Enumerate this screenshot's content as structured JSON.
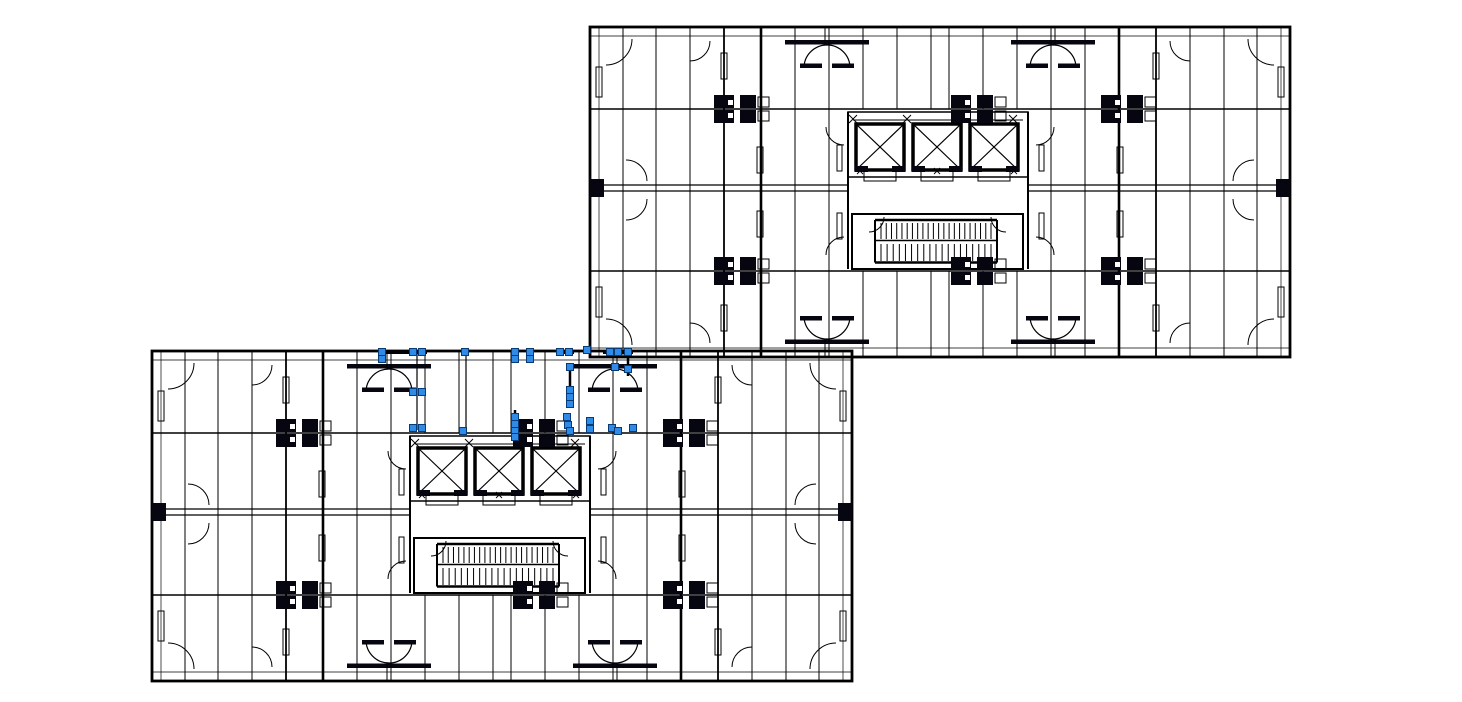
{
  "app": {
    "title": "CAD drawing - twin tower floor plans, lower plan selected"
  },
  "drawing": {
    "canvas": {
      "width": 1462,
      "height": 702,
      "background": "#ffffff"
    },
    "colors": {
      "line": "#000000",
      "fill_block": "#05060f",
      "grip_fill": "#2e8be8",
      "grip_stroke": "#083a75",
      "highlight": "#000000"
    },
    "plans": [
      {
        "name": "floor-plan-upper-right",
        "origin_x": 590,
        "origin_y": 27,
        "selected": false
      },
      {
        "name": "floor-plan-lower-left",
        "origin_x": 152,
        "origin_y": 351,
        "selected": true
      }
    ],
    "template": {
      "w": 700,
      "h": 330,
      "border_w": 2.8,
      "inner_h": [
        {
          "y": 9,
          "w": 0.7
        },
        {
          "y": 321,
          "w": 0.7
        }
      ],
      "inner_v": [
        {
          "x": 9,
          "w": 0.7
        },
        {
          "x": 691,
          "w": 0.7
        }
      ],
      "h_lines": [
        {
          "y": 82,
          "w": 1.4,
          "spans": [
            [
              0,
              700
            ]
          ]
        },
        {
          "y": 158,
          "w": 1.3,
          "spans": [
            [
              0,
              258
            ],
            [
              438,
              700
            ]
          ]
        },
        {
          "y": 164,
          "w": 1.3,
          "spans": [
            [
              0,
              258
            ],
            [
              438,
              700
            ]
          ]
        },
        {
          "y": 244,
          "w": 1.4,
          "spans": [
            [
              0,
              700
            ]
          ]
        }
      ],
      "v_full": [
        {
          "x": 33,
          "w": 1
        },
        {
          "x": 66,
          "w": 1
        },
        {
          "x": 100,
          "w": 1
        },
        {
          "x": 134,
          "w": 1.8
        },
        {
          "x": 171,
          "w": 2.6
        },
        {
          "x": 205,
          "w": 1
        },
        {
          "x": 239,
          "w": 1
        },
        {
          "x": 461,
          "w": 1
        },
        {
          "x": 495,
          "w": 1
        },
        {
          "x": 529,
          "w": 2.6
        },
        {
          "x": 566,
          "w": 1.8
        },
        {
          "x": 600,
          "w": 1
        },
        {
          "x": 634,
          "w": 1
        },
        {
          "x": 667,
          "w": 1
        }
      ],
      "v_center": [
        {
          "x": 273,
          "w": 1
        },
        {
          "x": 307,
          "w": 1
        },
        {
          "x": 341,
          "w": 1
        },
        {
          "x": 359,
          "w": 1
        },
        {
          "x": 393,
          "w": 1
        },
        {
          "x": 427,
          "w": 1
        }
      ],
      "v_center_bands": [
        [
          0,
          82
        ],
        [
          244,
          330
        ]
      ],
      "core_side_walls": [
        {
          "x": 258,
          "y1": 85,
          "y2": 242,
          "w": 2
        },
        {
          "x": 438,
          "y1": 85,
          "y2": 242,
          "w": 2
        }
      ],
      "elevator_bank": {
        "x": 258,
        "y": 85,
        "w": 180,
        "h": 65,
        "inner_top_y": 93,
        "shaft_xs": [
          266,
          323,
          380
        ],
        "shaft_y": 97,
        "shaft_w": 48,
        "shaft_h": 46,
        "shaft_wall": 3.5,
        "x_marks_top": [
          263,
          317,
          368,
          423
        ],
        "x_marks_top_y": 92,
        "x_marks_bot": [
          270,
          347,
          424
        ],
        "x_marks_bot_y": 144,
        "door_y": 144,
        "door_h": 10,
        "threshold_y": 139
      },
      "stair": {
        "x": 262,
        "y": 187,
        "w": 171,
        "h": 55,
        "wall": 2,
        "plate1_y": 193,
        "mid_y": 213.5,
        "plate2_y": 235.5,
        "tread_x1": 291,
        "tread_x2": 401,
        "run1": [
          196,
          212
        ],
        "run2": [
          217,
          234
        ],
        "treads1": 22,
        "treads2": 19,
        "rail_x1": 285,
        "rail_x2": 407
      },
      "blocks": [
        {
          "x": 150,
          "y": 82
        },
        {
          "x": 387,
          "y": 82
        },
        {
          "x": 537,
          "y": 82
        },
        {
          "x": 150,
          "y": 244
        },
        {
          "x": 387,
          "y": 244
        },
        {
          "x": 537,
          "y": 244
        }
      ],
      "edge_ticks": [
        {
          "x": 0,
          "y": 152,
          "w": 14,
          "h": 18
        },
        {
          "x": 686,
          "y": 152,
          "w": 14,
          "h": 18
        }
      ],
      "arcs": [
        {
          "x": 16,
          "y": 12,
          "r": 26,
          "dx": 1,
          "dy": 1,
          "sweep": 1
        },
        {
          "x": 684,
          "y": 12,
          "r": 26,
          "dx": -1,
          "dy": 1,
          "sweep": 0
        },
        {
          "x": 16,
          "y": 318,
          "r": 26,
          "dx": 1,
          "dy": -1,
          "sweep": 0
        },
        {
          "x": 684,
          "y": 318,
          "r": 26,
          "dx": -1,
          "dy": -1,
          "sweep": 1
        },
        {
          "x": 100,
          "y": 14,
          "r": 20,
          "dx": 1,
          "dy": 1,
          "sweep": 1
        },
        {
          "x": 600,
          "y": 14,
          "r": 20,
          "dx": -1,
          "dy": 1,
          "sweep": 0
        },
        {
          "x": 100,
          "y": 316,
          "r": 20,
          "dx": 1,
          "dy": -1,
          "sweep": 0
        },
        {
          "x": 600,
          "y": 316,
          "r": 20,
          "dx": -1,
          "dy": -1,
          "sweep": 1
        },
        {
          "x": 36,
          "y": 154,
          "r": 21,
          "dx": 1,
          "dy": -1,
          "sweep": 0
        },
        {
          "x": 36,
          "y": 172,
          "r": 21,
          "dx": 1,
          "dy": 1,
          "sweep": 1
        },
        {
          "x": 664,
          "y": 154,
          "r": 21,
          "dx": -1,
          "dy": -1,
          "sweep": 1
        },
        {
          "x": 664,
          "y": 172,
          "r": 21,
          "dx": -1,
          "dy": 1,
          "sweep": 0
        },
        {
          "x": 254,
          "y": 100,
          "r": 18,
          "dx": -1,
          "dy": 1,
          "sweep": 0
        },
        {
          "x": 446,
          "y": 100,
          "r": 18,
          "dx": 1,
          "dy": 1,
          "sweep": 1
        },
        {
          "x": 254,
          "y": 228,
          "r": 18,
          "dx": -1,
          "dy": -1,
          "sweep": 1
        },
        {
          "x": 446,
          "y": 228,
          "r": 18,
          "dx": 1,
          "dy": -1,
          "sweep": 0
        },
        {
          "x": 279,
          "y": 190,
          "r": 15,
          "dx": 1,
          "dy": 1,
          "sweep": 1
        },
        {
          "x": 416,
          "y": 190,
          "r": 15,
          "dx": -1,
          "dy": 1,
          "sweep": 0
        }
      ],
      "domes": [
        {
          "cx": 237,
          "base": 41,
          "dir": -1
        },
        {
          "cx": 463,
          "base": 41,
          "dir": -1
        },
        {
          "cx": 237,
          "base": 289,
          "dir": 1
        },
        {
          "cx": 463,
          "base": 289,
          "dir": 1
        }
      ],
      "jambs": [
        [
          6,
          40,
          6,
          30
        ],
        [
          6,
          260,
          6,
          30
        ],
        [
          688,
          40,
          6,
          30
        ],
        [
          688,
          260,
          6,
          30
        ],
        [
          131,
          26,
          6,
          26
        ],
        [
          131,
          278,
          6,
          26
        ],
        [
          563,
          26,
          6,
          26
        ],
        [
          563,
          278,
          6,
          26
        ],
        [
          167,
          120,
          6,
          26
        ],
        [
          167,
          184,
          6,
          26
        ],
        [
          527,
          120,
          6,
          26
        ],
        [
          527,
          184,
          6,
          26
        ],
        [
          247,
          118,
          5,
          26
        ],
        [
          449,
          118,
          5,
          26
        ],
        [
          247,
          186,
          5,
          26
        ],
        [
          449,
          186,
          5,
          26
        ]
      ]
    },
    "selection": {
      "grip_size": 7,
      "grips": [
        [
          382,
          352
        ],
        [
          413,
          352
        ],
        [
          422,
          352
        ],
        [
          465,
          352
        ],
        [
          515,
          352
        ],
        [
          530,
          352
        ],
        [
          560,
          352
        ],
        [
          569,
          352
        ],
        [
          587,
          350
        ],
        [
          610,
          352
        ],
        [
          618,
          352
        ],
        [
          628,
          352
        ],
        [
          382,
          359
        ],
        [
          515,
          359
        ],
        [
          530,
          359
        ],
        [
          570,
          367
        ],
        [
          615,
          367
        ],
        [
          628,
          369
        ],
        [
          413,
          392
        ],
        [
          422,
          392
        ],
        [
          413,
          428
        ],
        [
          422,
          428
        ],
        [
          570,
          390
        ],
        [
          570,
          397
        ],
        [
          570,
          404
        ],
        [
          515,
          417
        ],
        [
          515,
          424
        ],
        [
          515,
          431
        ],
        [
          515,
          437
        ],
        [
          463,
          431
        ],
        [
          567,
          417
        ],
        [
          568,
          425
        ],
        [
          570,
          431
        ],
        [
          590,
          421
        ],
        [
          590,
          429
        ],
        [
          612,
          428
        ],
        [
          618,
          431
        ],
        [
          633,
          428
        ]
      ],
      "highlight_segments": [
        [
          382,
          352,
          427,
          352,
          4
        ],
        [
          556,
          352,
          574,
          352,
          4
        ],
        [
          603,
          352,
          633,
          352,
          4
        ],
        [
          570,
          364,
          570,
          406,
          2.5
        ],
        [
          515,
          410,
          515,
          437,
          2.5
        ],
        [
          592,
          417,
          592,
          433,
          2.5
        ],
        [
          628,
          350,
          628,
          376,
          2.5
        ],
        [
          466,
          352,
          466,
          432,
          1.2
        ],
        [
          417,
          354,
          417,
          430,
          1.2
        ]
      ]
    }
  }
}
